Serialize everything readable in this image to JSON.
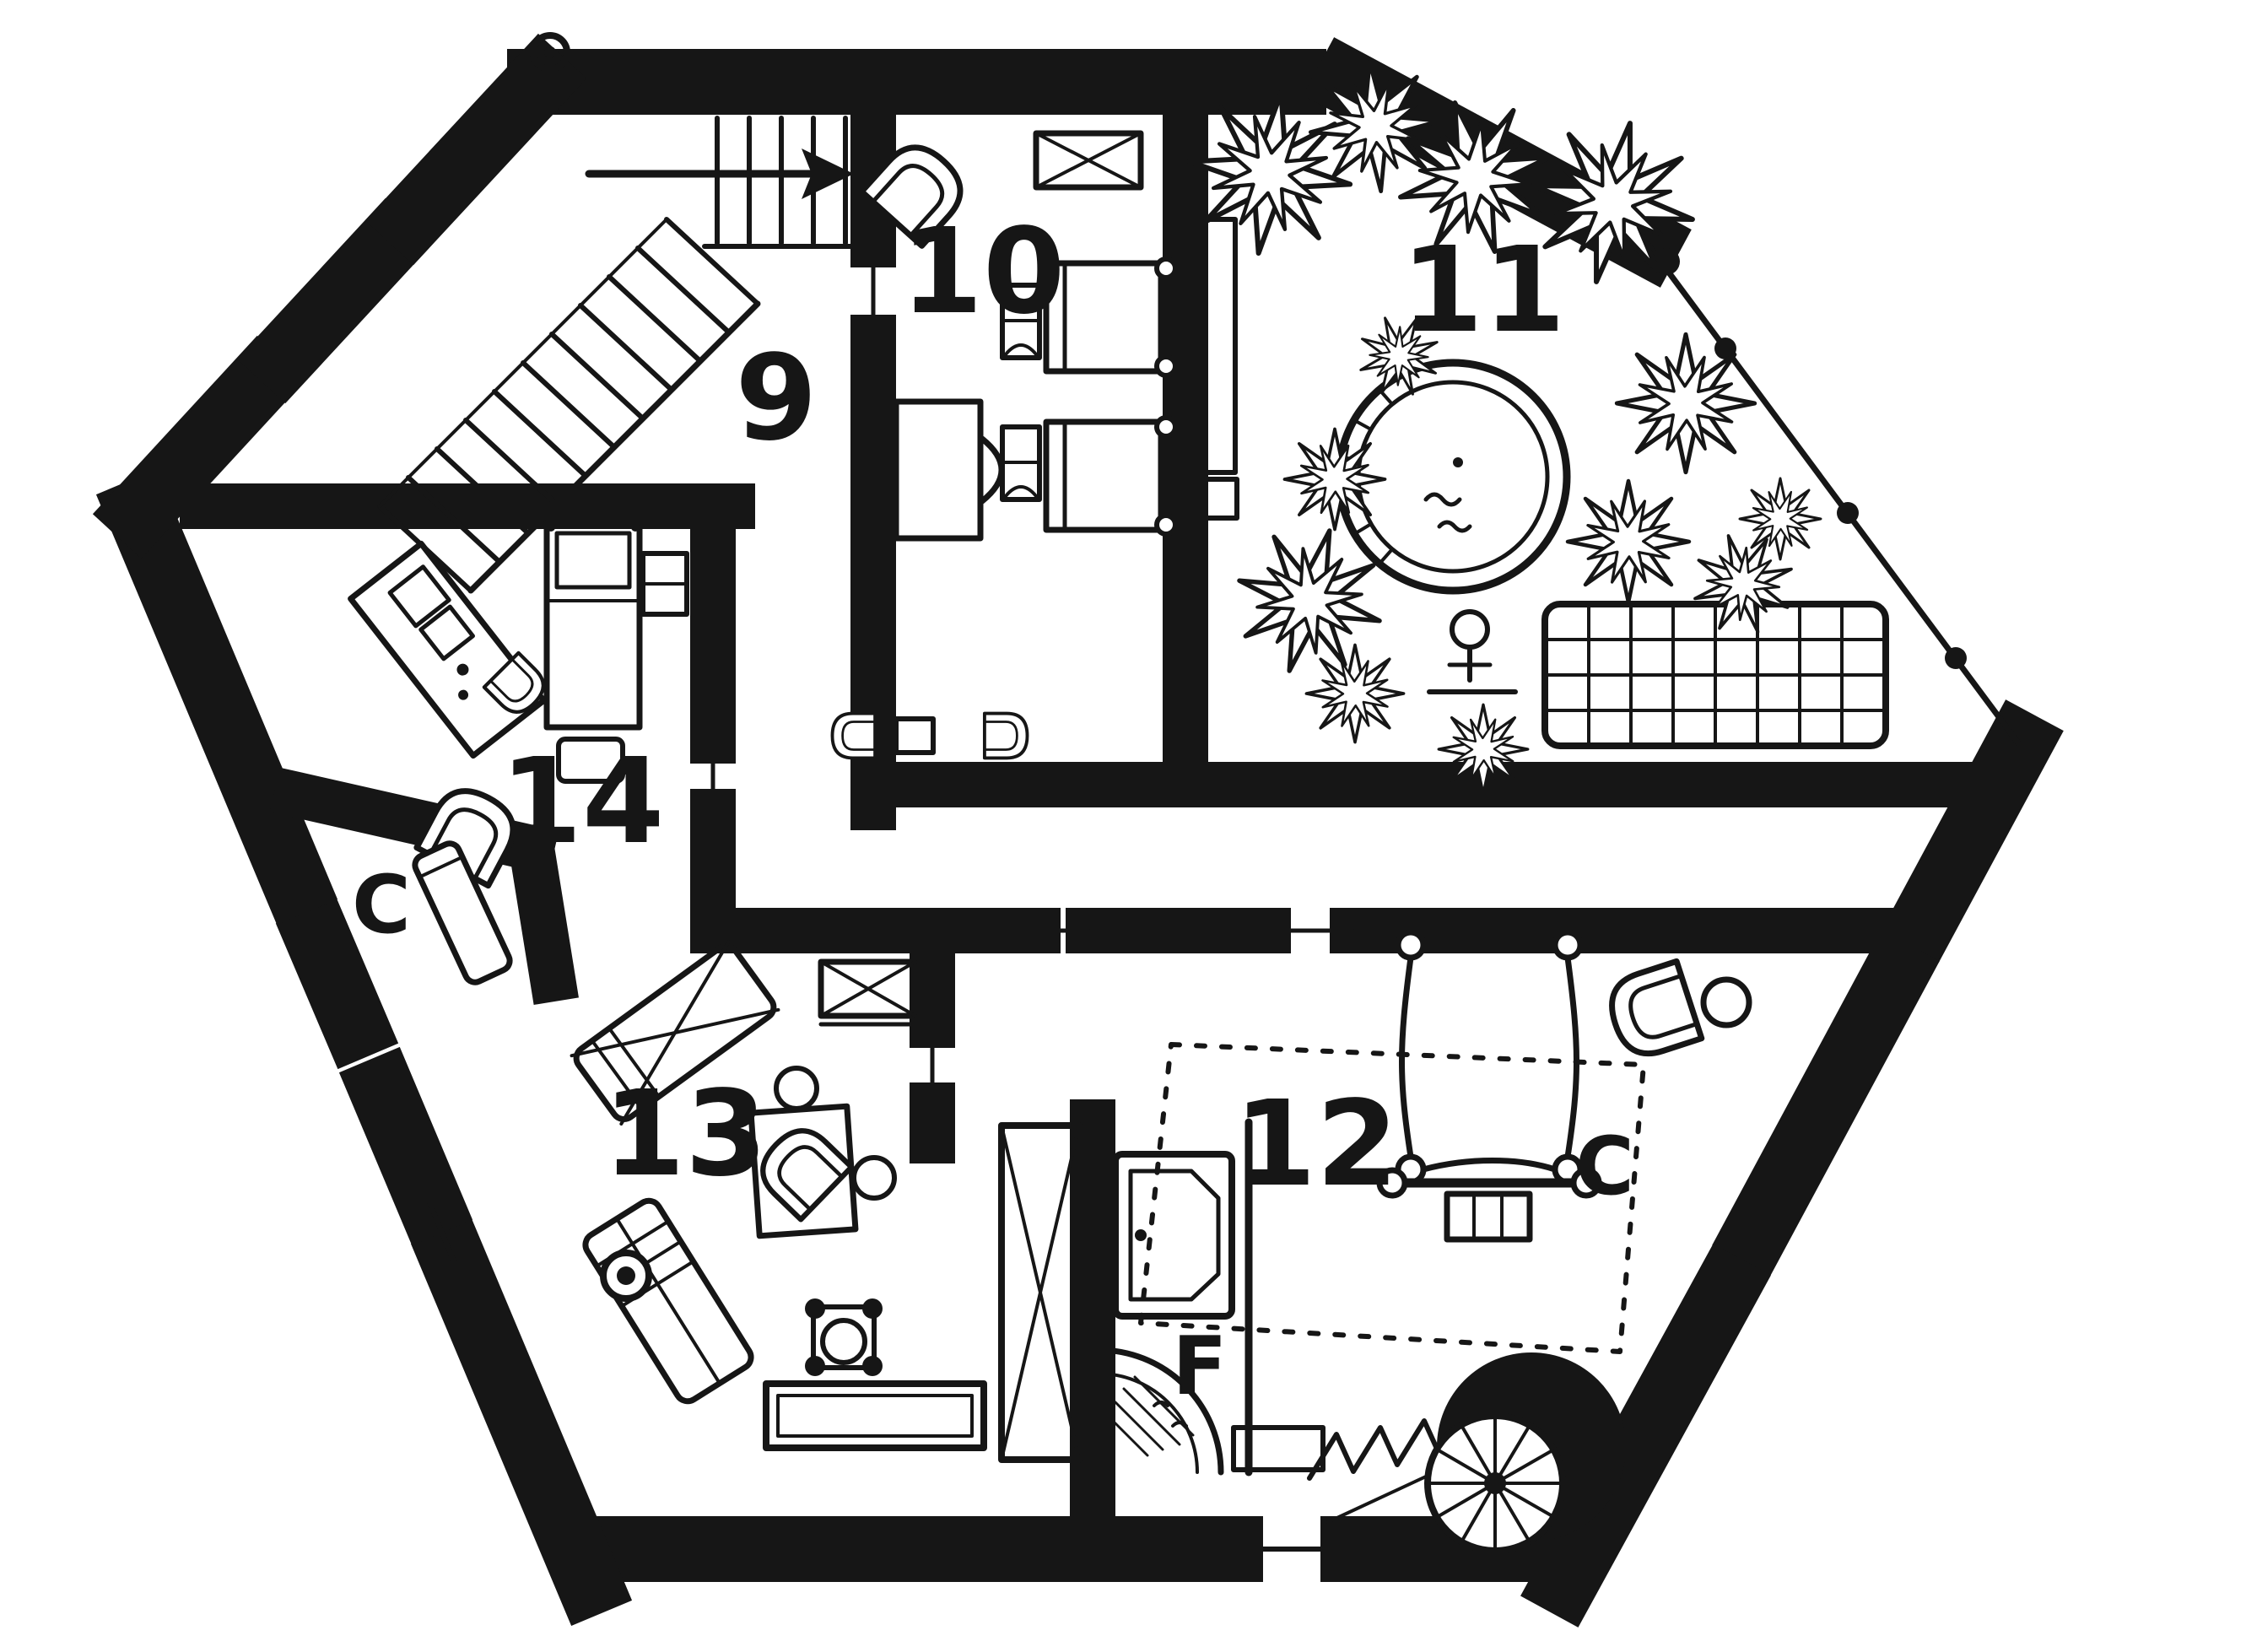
{
  "plan": {
    "paper_color": "#ffffff",
    "ink_color": "#161616",
    "room_labels": {
      "r9": "9",
      "r10": "10",
      "r11": "11",
      "r12": "12",
      "r13": "13",
      "r14": "14"
    },
    "closet_left_label": "C",
    "closet_right_label": "C",
    "bath_label": "F",
    "symbols": {
      "staircase": "staircase with up-arrow",
      "spiral_stair": "spiral staircase",
      "hot_tub": "round hot tub",
      "palm": "plant",
      "deck": "gridded deck",
      "shower": "corner shower",
      "bathtub": "bathtub"
    }
  }
}
